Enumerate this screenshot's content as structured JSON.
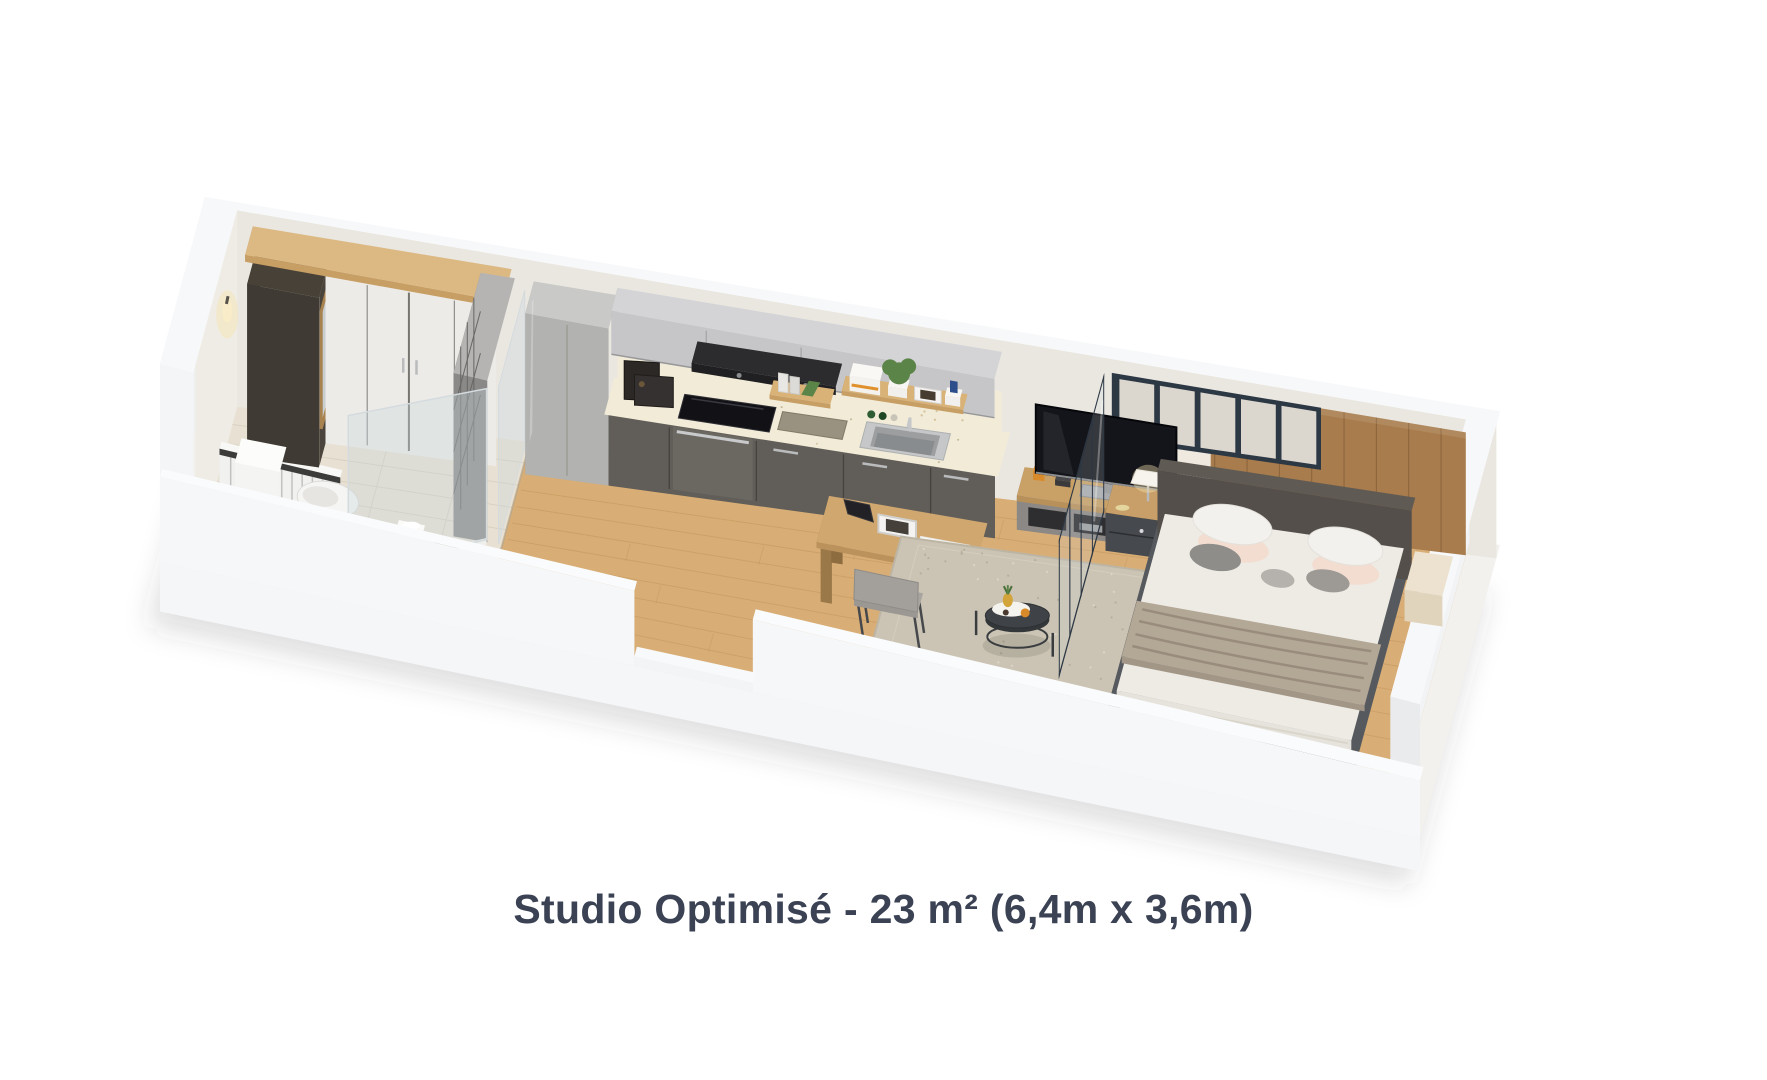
{
  "caption": {
    "text": "Studio Optimisé - 23 m² (6,4m x 3,6m)",
    "name": "Studio Optimisé",
    "area_label": "23 m²",
    "dimensions_label": "6,4m x 3,6m"
  },
  "palette": {
    "background": "#ffffff",
    "caption_color": "#3a4254",
    "slab_side": "#e9ebee",
    "slab_front": "#f5f6f8",
    "slab_top": "#f2f1ee",
    "wall_top": "#f7f8f9",
    "wall_inner": "#eae7e1",
    "wall_outer": "#eef0f2",
    "wall_face_bright": "#f4f5f7",
    "tile_floor": "#e8e1d3",
    "tile_line": "#d6cebe",
    "wood_floor": "#d9ae76",
    "wood_line": "#b98d52",
    "rug": "#cbc4b4",
    "rug_edge": "#bdb5a4",
    "wood_furniture": "#cda46c",
    "wood_dark": "#a87f4e",
    "cabinet_gray": "#c6c6c8",
    "cabinet_gray_side": "#a9a9ab",
    "cabinet_dark": "#615e59",
    "cabinet_dark_side": "#55524d",
    "counter_cream": "#f1ebd8",
    "hood_black": "#1c1c1e",
    "hob_black": "#121216",
    "steel": "#b9bbbd",
    "sink_steel": "#9c9ea0",
    "white_fixture": "#f3f3f1",
    "partition_frame": "#2d3845",
    "glazing_pane": "#dcd7ce",
    "glass": "rgba(200,214,220,0.35)",
    "glass_edge": "#d4dbde",
    "wood_wall": "#a87c4c",
    "bed_frame": "#4a4d52",
    "headboard": "#544f4a",
    "duvet": "#edebe4",
    "throw": "#b3a796",
    "pillow_white": "#f3f1ed",
    "pillow_blush": "#f3ddd1",
    "pillow_gray": "#8f8d89",
    "tv_black": "#14151a",
    "chair_gray": "#a09c97",
    "plant_green": "#5b8448",
    "lamp_warm": "#f6e3b2",
    "shadow": "rgba(60,65,70,0.16)"
  }
}
